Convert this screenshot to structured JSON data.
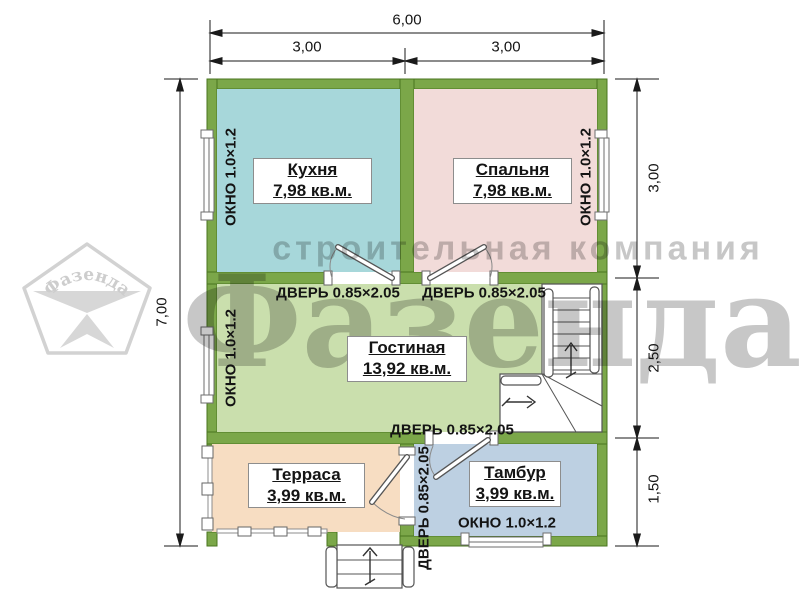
{
  "dimensions": {
    "total_width": "6,00",
    "width_left": "3,00",
    "width_right": "3,00",
    "total_height": "7,00",
    "right_top": "3,00",
    "right_middle": "2,50",
    "right_bottom": "1,50"
  },
  "labels": {
    "window": "ОКНО 1.0×1.2",
    "door": "ДВЕРЬ 0.85×2.05"
  },
  "rooms": {
    "kitchen": {
      "name": "Кухня",
      "area": "7,98 кв.м."
    },
    "bedroom": {
      "name": "Спальня",
      "area": "7,98 кв.м."
    },
    "living": {
      "name": "Гостиная",
      "area": "13,92 кв.м."
    },
    "terrace": {
      "name": "Терраса",
      "area": "3,99 кв.м."
    },
    "vestibule": {
      "name": "Тамбур",
      "area": "3,99 кв.м."
    }
  },
  "watermark": {
    "company": "строительная компания",
    "brand": "Фазенда",
    "logo": "Фазенда"
  },
  "colors": {
    "wall": "#7ba749",
    "wall_edge": "#49751f",
    "kitchen": "#a7d7da",
    "bedroom": "#f2dbd9",
    "living": "#cadfad",
    "terrace": "#f7ddc2",
    "vestibule": "#bdd0e2"
  }
}
